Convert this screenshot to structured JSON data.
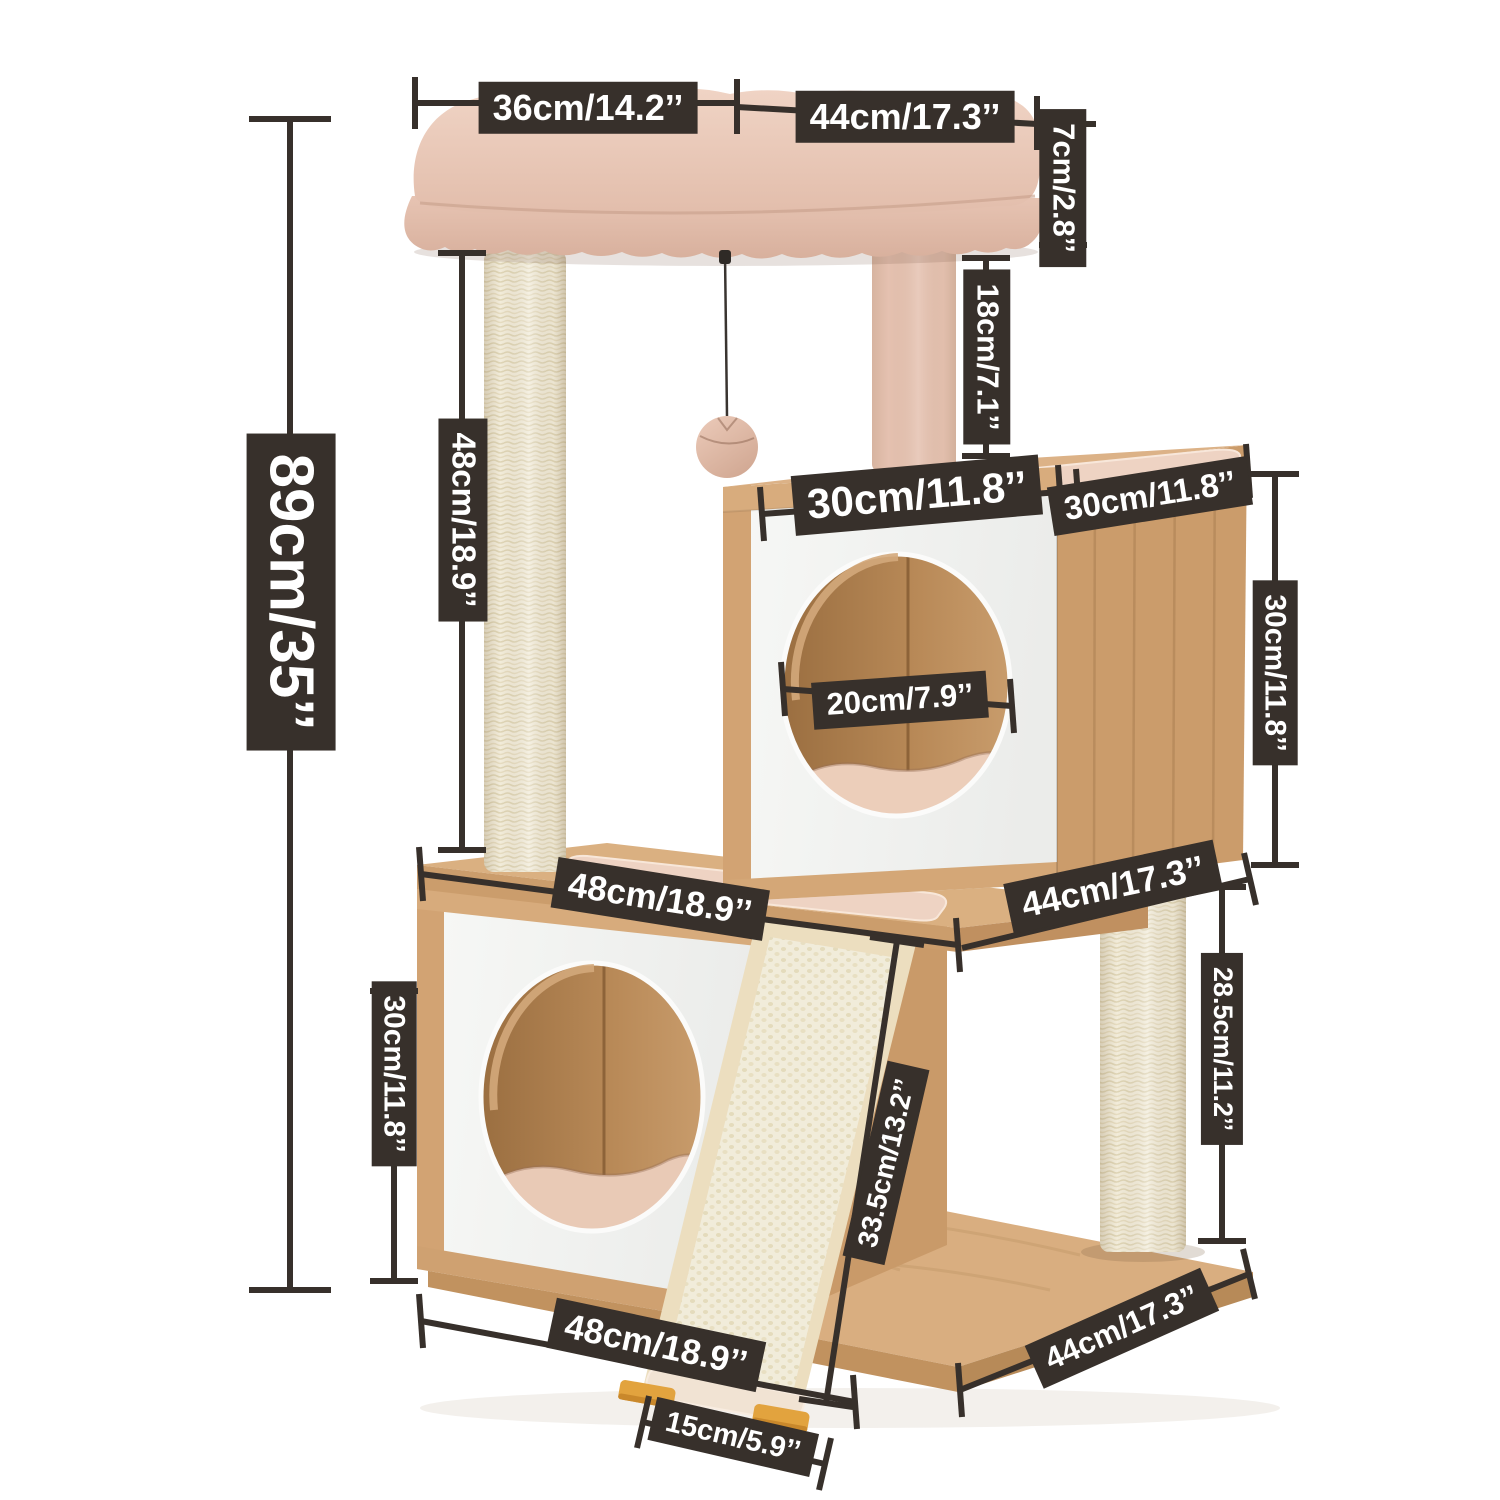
{
  "meta": {
    "description_label": "Cat tree tower dimension diagram"
  },
  "theme": {
    "label_bg": "#37302B",
    "label_text": "#FFFFFF",
    "line": "#37302B",
    "background": "#FFFFFF",
    "wood": "#D8AC7D",
    "wood_dark": "#C79866",
    "panel_white": "#F4F5F2",
    "sisal": "#F1EBD7",
    "plush_pink": "#E9CABB",
    "foot_orange": "#E2A33E"
  },
  "dims": {
    "d36": "36cm/14.2’’",
    "d44_top": "44cm/17.3’’",
    "d7": "7cm/2.8’’",
    "d18": "18cm/7.1’’",
    "d89": "89cm/35’’",
    "d48_post": "48cm/18.9’’",
    "d30_cube_top": "30cm/11.8’’",
    "d30_cube_side": "30cm/11.8’’",
    "d30_right": "30cm/11.8’’",
    "d20_hole": "20cm/7.9’’",
    "d48_mid": "48cm/18.9’’",
    "d44_mid": "44cm/17.3’’",
    "d30_lower": "30cm/11.8’’",
    "d33_ramp": "33.5cm/13.2’’",
    "d28_post": "28.5cm/11.2’’",
    "d48_bottom": "48cm/18.9’’",
    "d15_ramp": "15cm/5.9’’",
    "d44_bottom": "44cm/17.3’’"
  }
}
